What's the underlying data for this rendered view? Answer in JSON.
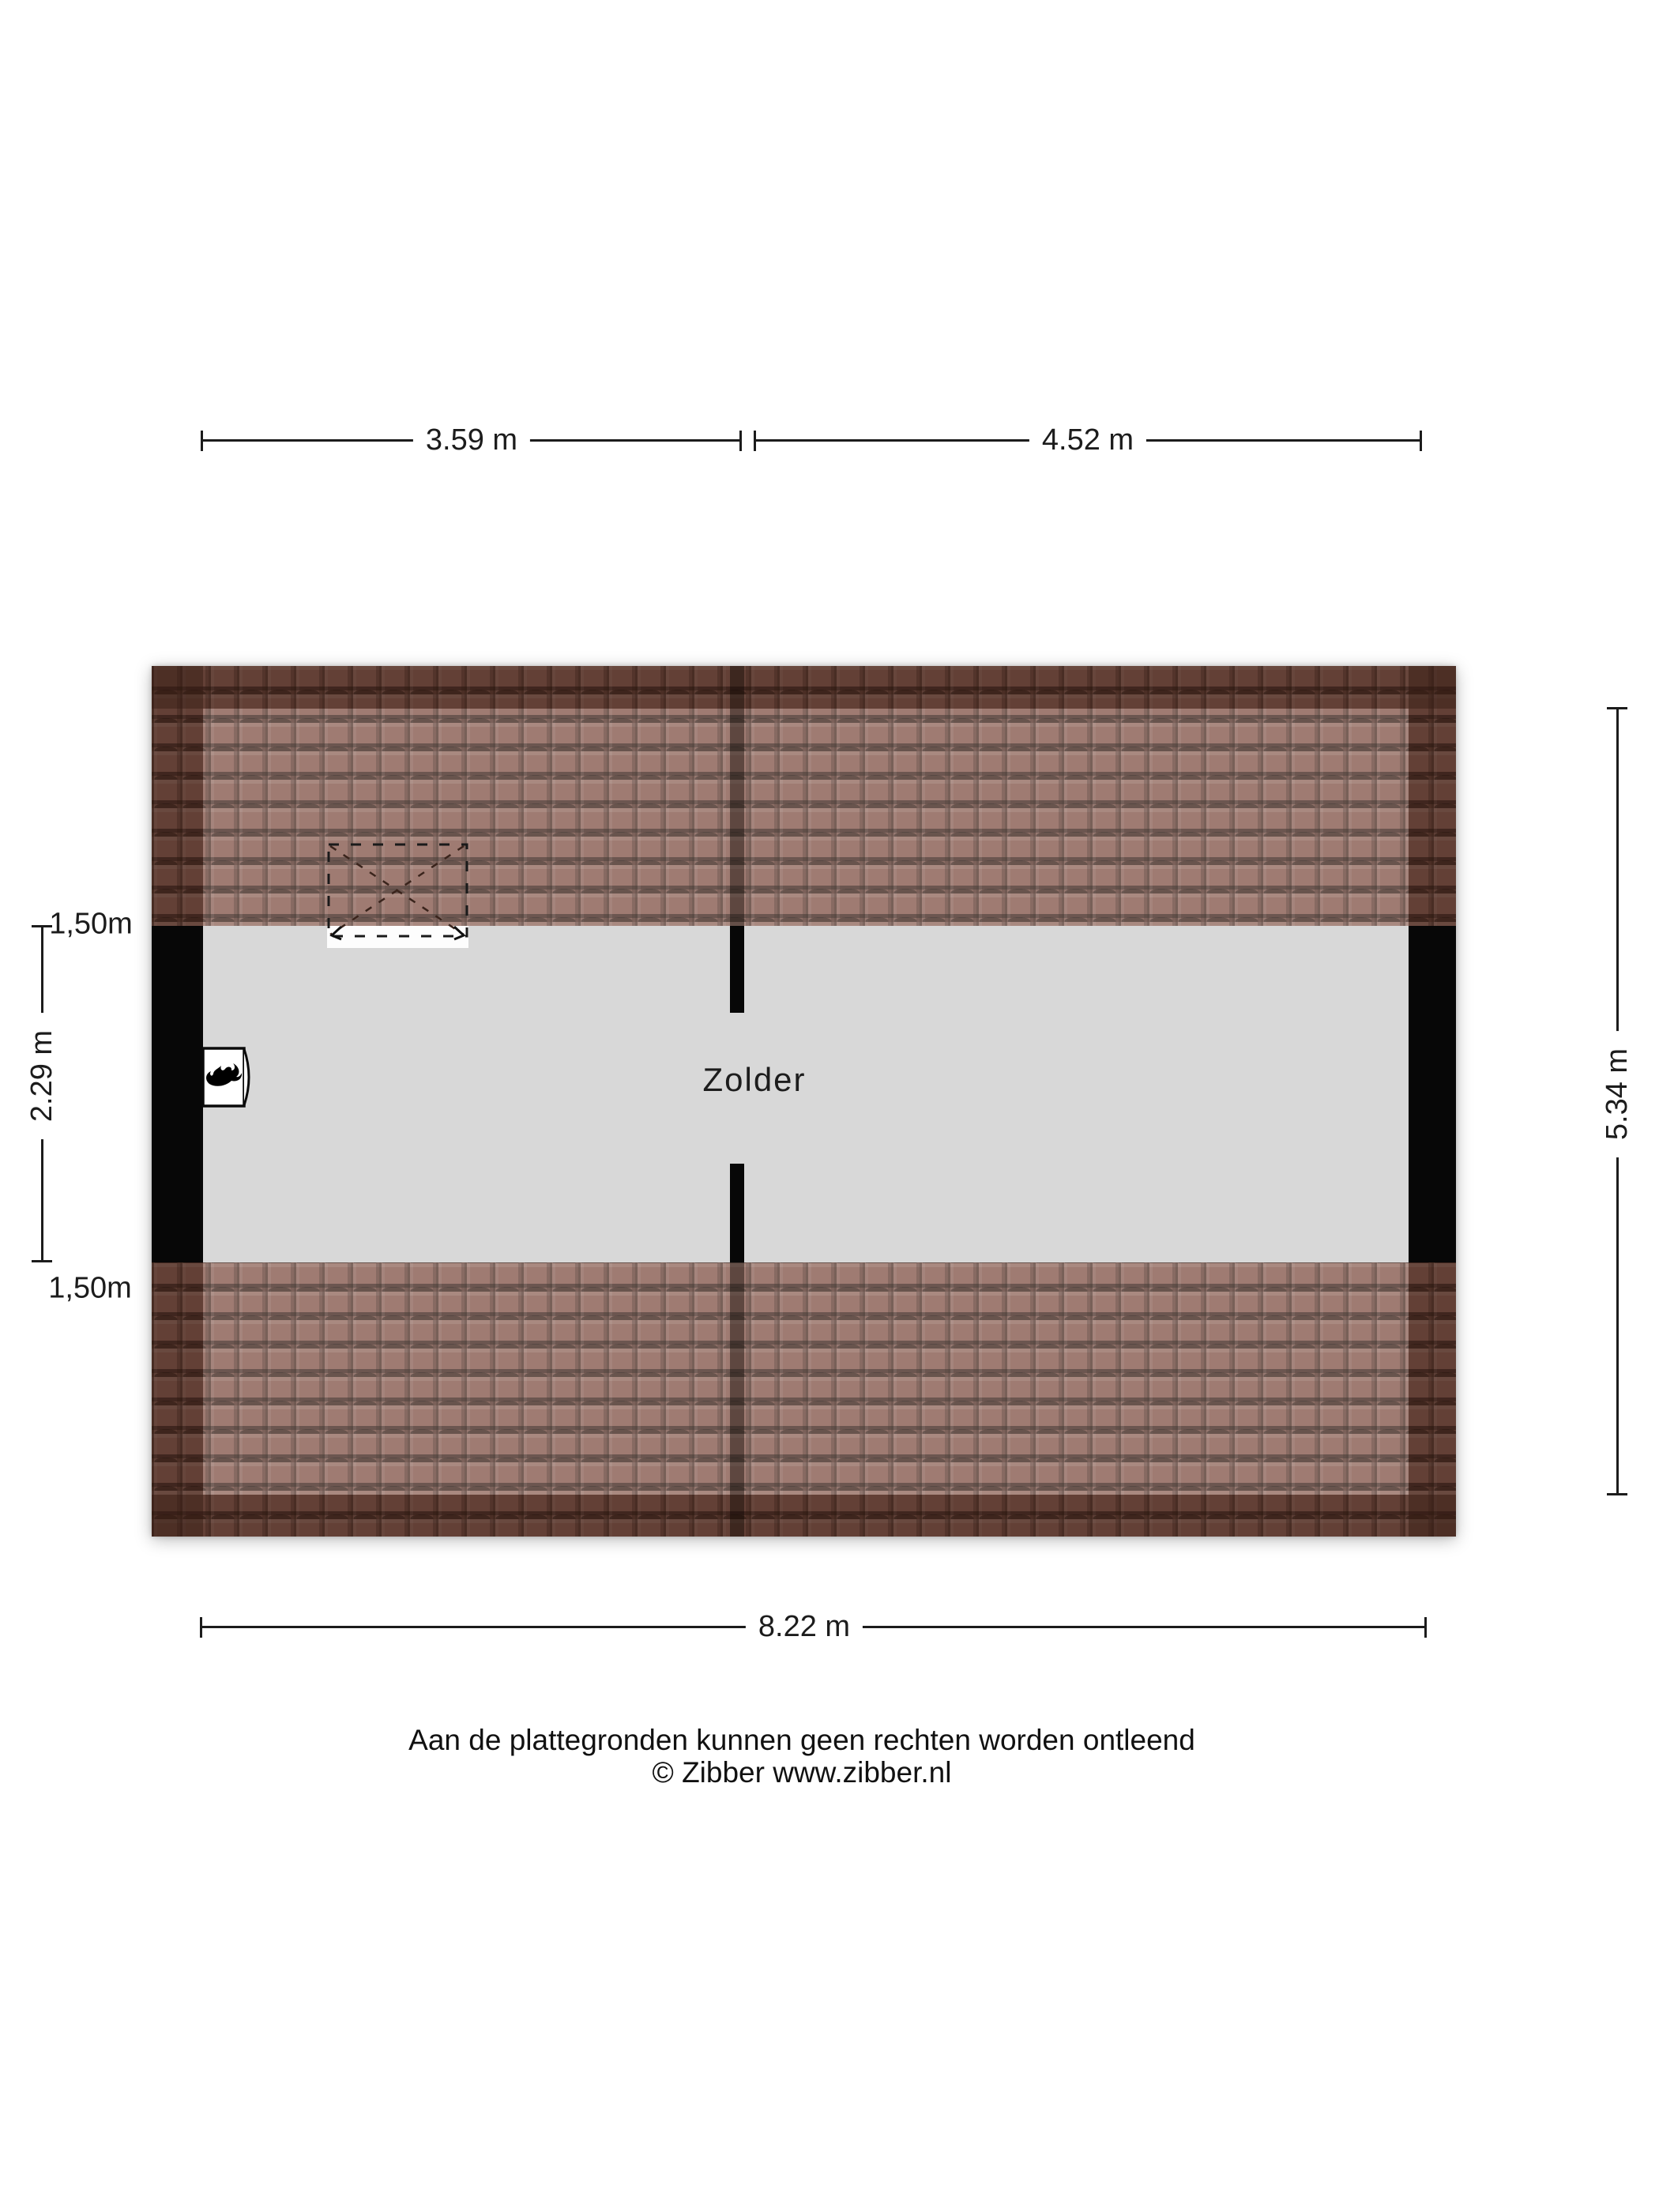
{
  "floorplan": {
    "room_label": "Zolder",
    "dimensions": {
      "top_left_width": "3.59 m",
      "top_right_width": "4.52 m",
      "bottom_width": "8.22 m",
      "room_depth": "2.29 m",
      "building_depth": "5.34 m",
      "clearance_top": "1,50m",
      "clearance_bottom": "1,50m"
    },
    "colors": {
      "roof_tile_base": "#8a5f54",
      "roof_tile_outer_band": "#5e3f36",
      "floor": "#d8d8d8",
      "wall": "#070707",
      "dimension_text": "#1c1c1c"
    },
    "icons": {
      "boiler": "flame-icon",
      "roof_window": "roof-window-dashed-outline"
    }
  },
  "footer": {
    "disclaimer": "Aan de plattegronden kunnen geen rechten worden ontleend",
    "copyright": "© Zibber www.zibber.nl"
  }
}
